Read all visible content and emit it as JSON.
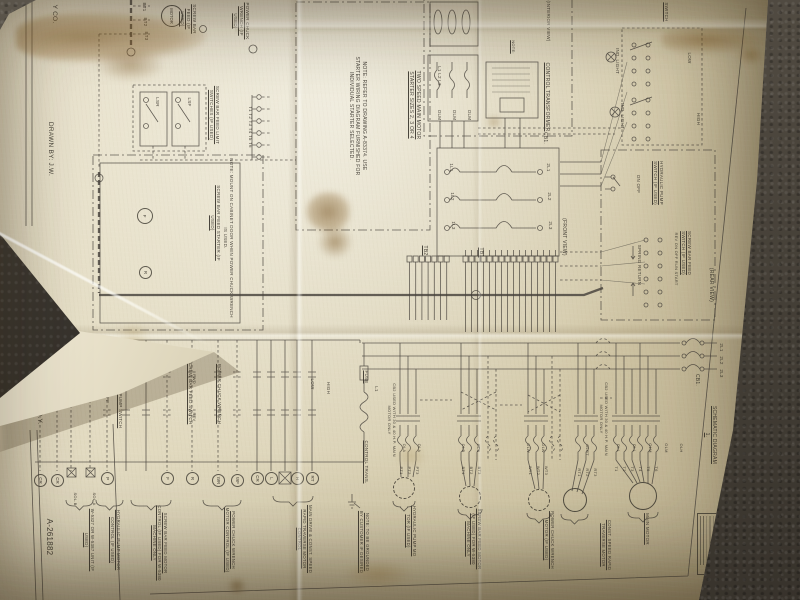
{
  "document": {
    "type": "photograph of an electrical wiring diagram drawing, rotated 90 degrees on dark carpet",
    "drawing_number": "A-261882"
  },
  "colors": {
    "paper": "#e0d8bd",
    "ink": "#45413a",
    "carpet": "#4b463e",
    "stain": "#7a541e"
  },
  "labels": [
    {
      "n": "company-name",
      "t": "Y CO.",
      "x": 58,
      "y": 2,
      "w": 24,
      "fs": 6.5,
      "ul": false
    },
    {
      "n": "drawn-by",
      "t": "DRAWN BY: J.W.",
      "x": 54,
      "y": 120,
      "w": 58,
      "fs": 6.5,
      "ul": false
    },
    {
      "n": "approved-by",
      "t": "APPR. BY: R.Y.",
      "x": 43,
      "y": 374,
      "w": 52,
      "fs": 6.5,
      "ul": false
    },
    {
      "n": "drawing-number",
      "t": "A-261882",
      "x": 54,
      "y": 514,
      "w": 46,
      "fs": 8,
      "ul": false
    },
    {
      "n": "terminal-bt1",
      "t": "BT1",
      "x": 147,
      "y": 1,
      "w": 12,
      "fs": 4.5,
      "ul": false
    },
    {
      "n": "terminal-bt2",
      "t": "BT2",
      "x": 148,
      "y": 16,
      "w": 12,
      "fs": 4.5,
      "ul": false
    },
    {
      "n": "terminal-bt3",
      "t": "BT3",
      "x": 149,
      "y": 30,
      "w": 12,
      "fs": 4.5,
      "ul": false
    },
    {
      "n": "screw-bar-feed-motor-top",
      "t": "SCREW BAR FEED (IF USED)",
      "x": 197,
      "y": 1,
      "w": 36,
      "fs": 4.5,
      "ul": true
    },
    {
      "n": "limit-switches",
      "t": "SCREW BAR FEED LIMIT SWITCHES (IF USED)",
      "x": 220,
      "y": 83,
      "w": 64,
      "fs": 4.5,
      "ul": true
    },
    {
      "n": "lsr",
      "t": "LSR",
      "x": 160,
      "y": 95,
      "w": 14,
      "fs": 4.5,
      "ul": false
    },
    {
      "n": "lsf",
      "t": "LSF",
      "x": 192,
      "y": 95,
      "w": 14,
      "fs": 4.5,
      "ul": false
    },
    {
      "n": "terminals-t1-t6",
      "t": "T1 T2 T3 T4 T5 T6",
      "x": 253,
      "y": 92,
      "w": 70,
      "fs": 4.5,
      "ul": false
    },
    {
      "n": "screw-bar-feed-starter",
      "t": "SCREW BAR FEED STARTER (IF USED)",
      "x": 221,
      "y": 178,
      "w": 90,
      "fs": 4.5,
      "ul": true
    },
    {
      "n": "starter-mount-note",
      "t": "NOTE: MOUNT ON CABINET DOOR WHEN POWER CHUCK WRENCH IS USED.",
      "x": 234,
      "y": 158,
      "w": 160,
      "fs": 4.5,
      "ul": false
    },
    {
      "n": "power-chuck-wrench-top",
      "t": "POWER CHUCK WRENCH (IF USED)",
      "x": 250,
      "y": 1,
      "w": 40,
      "fs": 4.5,
      "ul": true
    },
    {
      "n": "note-refer-drawing",
      "t": "NOTE: REFER TO DRAWING A-83374. USE STARTER WIRING DIAGRAM FURNISHED FOR INDIVIDUAL STARTER SELECTED.",
      "x": 367,
      "y": 56,
      "w": 120,
      "fs": 5,
      "ul": false
    },
    {
      "n": "two-speed-starter",
      "t": "TWO SPEED MAIN MOTOR STARTER SIZES 2, 3 OR 4",
      "x": 421,
      "y": 70,
      "w": 70,
      "fs": 5,
      "ul": true
    },
    {
      "n": "interior-view",
      "t": "(INTERIOR VIEW)",
      "x": 551,
      "y": 0,
      "w": 42,
      "fs": 4.5,
      "ul": false
    },
    {
      "n": "phase-l1l2l3",
      "t": "L1 L2 L3",
      "x": 442,
      "y": 58,
      "w": 36,
      "fs": 4.5,
      "ul": false
    },
    {
      "n": "olm-1",
      "t": "OLM",
      "x": 442,
      "y": 107,
      "w": 16,
      "fs": 4.5,
      "ul": false
    },
    {
      "n": "olm-2",
      "t": "OLM",
      "x": 457,
      "y": 107,
      "w": 16,
      "fs": 4.5,
      "ul": false
    },
    {
      "n": "olm-3",
      "t": "OLM",
      "x": 472,
      "y": 107,
      "w": 16,
      "fs": 4.5,
      "ul": false
    },
    {
      "n": "note-small",
      "t": "NOTE:",
      "x": 516,
      "y": 37,
      "w": 20,
      "fs": 4,
      "ul": true
    },
    {
      "n": "control-transformer",
      "t": "CONTROL TRANSFORMER",
      "x": 550,
      "y": 53,
      "w": 88,
      "fs": 5,
      "ul": true
    },
    {
      "n": "cb1-top",
      "t": "CB1.",
      "x": 548,
      "y": 130,
      "w": 16,
      "fs": 5,
      "ul": false
    },
    {
      "n": "switch-top",
      "t": "SWITCH",
      "x": 669,
      "y": 0,
      "w": 24,
      "fs": 4.5,
      "ul": true
    },
    {
      "n": "ind-light-1",
      "t": "IND. LIGHT",
      "x": 620,
      "y": 46,
      "w": 30,
      "fs": 4.5,
      "ul": false
    },
    {
      "n": "ind-light-2",
      "t": "IND. LIGHT",
      "x": 625,
      "y": 101,
      "w": 30,
      "fs": 4.5,
      "ul": false
    },
    {
      "n": "drum-low",
      "t": "LOW",
      "x": 692,
      "y": 50,
      "w": 16,
      "fs": 4.5,
      "ul": false
    },
    {
      "n": "drum-high",
      "t": "HIGH",
      "x": 701,
      "y": 110,
      "w": 18,
      "fs": 4.5,
      "ul": false
    },
    {
      "n": "hydraulic-pump-switch-r",
      "t": "HYDRAULIC PUMP SWITCH (IF USED)",
      "x": 664,
      "y": 160,
      "w": 46,
      "fs": 4.5,
      "ul": true
    },
    {
      "n": "hyd-on-off",
      "t": "ON OFF",
      "x": 641,
      "y": 172,
      "w": 24,
      "fs": 4.5,
      "ul": false
    },
    {
      "n": "screw-bar-feed-switch-r",
      "t": "SCREW BAR FEED SWITCH (IF USED)",
      "x": 692,
      "y": 226,
      "w": 54,
      "fs": 4.5,
      "ul": true
    },
    {
      "n": "sbf-positions",
      "t": "REV ON OFF RUN START",
      "x": 679,
      "y": 230,
      "w": 58,
      "fs": 4,
      "ul": false
    },
    {
      "n": "spring-return",
      "t": "SPRING RETURN",
      "x": 642,
      "y": 241,
      "w": 48,
      "fs": 4.5,
      "ul": false
    },
    {
      "n": "rear-view",
      "t": "(REAR VIEW)",
      "x": 714,
      "y": 263,
      "w": 44,
      "fs": 5,
      "ul": false
    },
    {
      "n": "breaker-1l1",
      "t": "1L1",
      "x": 454,
      "y": 161,
      "w": 13,
      "fs": 4.5,
      "ul": false
    },
    {
      "n": "breaker-1l2",
      "t": "1L2",
      "x": 455,
      "y": 190,
      "w": 13,
      "fs": 4.5,
      "ul": false
    },
    {
      "n": "breaker-1l3",
      "t": "1L3",
      "x": 456,
      "y": 219,
      "w": 13,
      "fs": 4.5,
      "ul": false
    },
    {
      "n": "breaker-2l1",
      "t": "2L1",
      "x": 551,
      "y": 161,
      "w": 13,
      "fs": 4.5,
      "ul": false
    },
    {
      "n": "breaker-2l2",
      "t": "2L2",
      "x": 552,
      "y": 190,
      "w": 13,
      "fs": 4.5,
      "ul": false
    },
    {
      "n": "breaker-2l3",
      "t": "2L3",
      "x": 553,
      "y": 219,
      "w": 13,
      "fs": 4.5,
      "ul": false
    },
    {
      "n": "front-view",
      "t": "(FRONT VIEW)",
      "x": 567,
      "y": 210,
      "w": 54,
      "fs": 5,
      "ul": false
    },
    {
      "n": "tb2",
      "t": "TB2",
      "x": 428,
      "y": 243,
      "w": 15,
      "fs": 5,
      "ul": true
    },
    {
      "n": "tb1",
      "t": "TB1",
      "x": 484,
      "y": 245,
      "w": 15,
      "fs": 5,
      "ul": true
    },
    {
      "n": "fuse",
      "t": "FUSE",
      "x": 369,
      "y": 368,
      "w": 18,
      "fs": 4.5,
      "ul": true
    },
    {
      "n": "line-l1",
      "t": "L1",
      "x": 379,
      "y": 384,
      "w": 10,
      "fs": 4.5,
      "ul": false
    },
    {
      "n": "control-trans-schematic",
      "t": "CONTROL TRANS.",
      "x": 369,
      "y": 436,
      "w": 52,
      "fs": 4.5,
      "ul": true
    },
    {
      "n": "cb2-note-left",
      "t": "CB2 USED WITH 30 & 40 H.P. MAIN MOTOR ONLY",
      "x": 397,
      "y": 376,
      "w": 88,
      "fs": 4,
      "ul": false
    },
    {
      "n": "cb2-note-right",
      "t": "CB2 USED WITH 30 & 40 H.P. MAIN MOTOR ONLY",
      "x": 609,
      "y": 374,
      "w": 90,
      "fs": 4,
      "ul": false
    },
    {
      "n": "cb1-right",
      "t": "CB1.",
      "x": 700,
      "y": 372,
      "w": 16,
      "fs": 5,
      "ul": false
    },
    {
      "n": "sch-2l1",
      "t": "2L1",
      "x": 724,
      "y": 341,
      "w": 13,
      "fs": 4.5,
      "ul": false
    },
    {
      "n": "sch-2l2",
      "t": "2L2",
      "x": 724,
      "y": 354,
      "w": 13,
      "fs": 4.5,
      "ul": false
    },
    {
      "n": "sch-2l3",
      "t": "2L3",
      "x": 724,
      "y": 367,
      "w": 13,
      "fs": 4.5,
      "ul": false
    },
    {
      "n": "schematic-diagram-title",
      "t": "SCHEMATIC DIAGRAM 1.",
      "x": 717,
      "y": 403,
      "w": 64,
      "fs": 5,
      "ul": true
    },
    {
      "n": "ol-a1",
      "t": "OLA",
      "x": 407,
      "y": 441,
      "w": 14,
      "fs": 4,
      "ul": false
    },
    {
      "n": "ol-a2",
      "t": "OLA",
      "x": 422,
      "y": 441,
      "w": 14,
      "fs": 4,
      "ul": false
    },
    {
      "n": "ol-b1",
      "t": "OLB",
      "x": 466,
      "y": 441,
      "w": 14,
      "fs": 4,
      "ul": false
    },
    {
      "n": "ol-b2",
      "t": "OLB",
      "x": 481,
      "y": 441,
      "w": 14,
      "fs": 4,
      "ul": false
    },
    {
      "n": "ol-w1",
      "t": "OLW",
      "x": 531,
      "y": 441,
      "w": 14,
      "fs": 4,
      "ul": false
    },
    {
      "n": "ol-w2",
      "t": "OLW",
      "x": 546,
      "y": 441,
      "w": 14,
      "fs": 4,
      "ul": false
    },
    {
      "n": "ol-rt",
      "t": "OLRT",
      "x": 590,
      "y": 441,
      "w": 18,
      "fs": 4,
      "ul": false
    },
    {
      "n": "ol-l1",
      "t": "OLL",
      "x": 621,
      "y": 441,
      "w": 14,
      "fs": 4,
      "ul": false
    },
    {
      "n": "ol-l2",
      "t": "OLL",
      "x": 637,
      "y": 441,
      "w": 14,
      "fs": 4,
      "ul": false
    },
    {
      "n": "ol-m1",
      "t": "OLM",
      "x": 653,
      "y": 441,
      "w": 14,
      "fs": 4,
      "ul": false
    },
    {
      "n": "ol-m2",
      "t": "OLM",
      "x": 669,
      "y": 441,
      "w": 14,
      "fs": 4,
      "ul": false
    },
    {
      "n": "ol-h",
      "t": "OLH",
      "x": 684,
      "y": 441,
      "w": 14,
      "fs": 4,
      "ul": false
    },
    {
      "n": "term-pt1",
      "t": "PT1",
      "x": 404,
      "y": 464,
      "w": 13,
      "fs": 4,
      "ul": false
    },
    {
      "n": "term-pt2",
      "t": "PT2",
      "x": 412,
      "y": 464,
      "w": 13,
      "fs": 4,
      "ul": false
    },
    {
      "n": "term-pt3",
      "t": "PT3",
      "x": 420,
      "y": 464,
      "w": 13,
      "fs": 4,
      "ul": false
    },
    {
      "n": "term-bt1",
      "t": "BT1",
      "x": 466,
      "y": 464,
      "w": 13,
      "fs": 4,
      "ul": false
    },
    {
      "n": "term-bt2",
      "t": "BT2",
      "x": 474,
      "y": 464,
      "w": 13,
      "fs": 4,
      "ul": false
    },
    {
      "n": "term-bt3",
      "t": "BT3",
      "x": 482,
      "y": 464,
      "w": 13,
      "fs": 4,
      "ul": false
    },
    {
      "n": "term-wt1",
      "t": "WT1",
      "x": 533,
      "y": 464,
      "w": 13,
      "fs": 4,
      "ul": false
    },
    {
      "n": "term-wt2",
      "t": "WT2",
      "x": 541,
      "y": 464,
      "w": 13,
      "fs": 4,
      "ul": false
    },
    {
      "n": "term-wt3",
      "t": "WT3",
      "x": 549,
      "y": 464,
      "w": 13,
      "fs": 4,
      "ul": false
    },
    {
      "n": "term-rt1",
      "t": "RT1",
      "x": 582,
      "y": 466,
      "w": 13,
      "fs": 4,
      "ul": false
    },
    {
      "n": "term-rt2",
      "t": "RT2",
      "x": 590,
      "y": 466,
      "w": 13,
      "fs": 4,
      "ul": false
    },
    {
      "n": "term-rt3",
      "t": "RT3",
      "x": 598,
      "y": 466,
      "w": 13,
      "fs": 4,
      "ul": false
    },
    {
      "n": "term-t1",
      "t": "T1",
      "x": 619,
      "y": 464,
      "w": 10,
      "fs": 4,
      "ul": false
    },
    {
      "n": "term-t2",
      "t": "T2",
      "x": 627,
      "y": 464,
      "w": 10,
      "fs": 4,
      "ul": false
    },
    {
      "n": "term-t3",
      "t": "T3",
      "x": 635,
      "y": 464,
      "w": 10,
      "fs": 4,
      "ul": false
    },
    {
      "n": "term-t4",
      "t": "T4",
      "x": 643,
      "y": 464,
      "w": 10,
      "fs": 4,
      "ul": false
    },
    {
      "n": "term-t5",
      "t": "T5",
      "x": 651,
      "y": 464,
      "w": 10,
      "fs": 4,
      "ul": false
    },
    {
      "n": "term-t6",
      "t": "T6",
      "x": 659,
      "y": 464,
      "w": 10,
      "fs": 4,
      "ul": false
    },
    {
      "n": "ladder-on-off",
      "t": "ON OFF",
      "x": 110,
      "y": 382,
      "w": 24,
      "fs": 4.5,
      "ul": false
    },
    {
      "n": "hydraulic-pump-switch-l",
      "t": "HYDRAULIC PUMP SWITCH",
      "x": 123,
      "y": 358,
      "w": 76,
      "fs": 4.5,
      "ul": true
    },
    {
      "n": "screw-bar-feed-switch-l",
      "t": "SCREW BAR FEED SWITCH",
      "x": 193,
      "y": 352,
      "w": 80,
      "fs": 4.5,
      "ul": true
    },
    {
      "n": "ladder-fwd",
      "t": "FWD",
      "x": 197,
      "y": 372,
      "w": 14,
      "fs": 4,
      "ul": false
    },
    {
      "n": "ladder-rev",
      "t": "REV",
      "x": 197,
      "y": 410,
      "w": 14,
      "fs": 4,
      "ul": false
    },
    {
      "n": "power-chuck-wrench-l",
      "t": "POWER CHUCK WRENCH",
      "x": 222,
      "y": 360,
      "w": 68,
      "fs": 4.5,
      "ul": true
    },
    {
      "n": "ladder-low",
      "t": "LOW",
      "x": 315,
      "y": 376,
      "w": 16,
      "fs": 4.5,
      "ul": false
    },
    {
      "n": "ladder-high",
      "t": "HIGH",
      "x": 331,
      "y": 379,
      "w": 18,
      "fs": 4.5,
      "ul": false
    },
    {
      "n": "sol-b",
      "t": "SOL.B",
      "x": 78,
      "y": 489,
      "w": 20,
      "fs": 4,
      "ul": false
    },
    {
      "n": "sol-a",
      "t": "SOL.A",
      "x": 97,
      "y": 489,
      "w": 20,
      "fs": 4,
      "ul": false
    },
    {
      "n": "bracket-w5327-unit",
      "t": "W-5327 OR W-5387 UNIT (IF USED)",
      "x": 95,
      "y": 503,
      "w": 74,
      "fs": 4.3,
      "ul": true
    },
    {
      "n": "bracket-hyd-pump-control",
      "t": "HYDRAULIC PUMP MOTOR CONTROL (IF USED)",
      "x": 121,
      "y": 503,
      "w": 74,
      "fs": 4.3,
      "ul": true
    },
    {
      "n": "bracket-sbf-control",
      "t": "SCREW BAR FEED MOTOR CONTROL (IF USED) FOR W-5380 MACHINE ONLY",
      "x": 168,
      "y": 503,
      "w": 80,
      "fs": 4.3,
      "ul": true
    },
    {
      "n": "bracket-pcw-control",
      "t": "POWER CHUCK WRENCH MOTOR CONTROL (IF USED)",
      "x": 236,
      "y": 503,
      "w": 74,
      "fs": 4.3,
      "ul": true
    },
    {
      "n": "bracket-main-drive-control",
      "t": "MAIN DRIVE & CONST. SPEED RAPID TRAVERSE MOTOR CONTROL",
      "x": 313,
      "y": 498,
      "w": 82,
      "fs": 4.3,
      "ul": true
    },
    {
      "n": "hydraulic-pump-motor",
      "t": "HYDRAULIC PUMP MO TOR (IF USED)",
      "x": 417,
      "y": 502,
      "w": 58,
      "fs": 4.3,
      "ul": true
    },
    {
      "n": "screw-bar-feed-motor",
      "t": "SCREW BAR FEED MOTOR (IF USED) FOR W-5380 MACHINE ONLY",
      "x": 482,
      "y": 506,
      "w": 66,
      "fs": 4.3,
      "ul": true
    },
    {
      "n": "power-chuck-wrench-motor",
      "t": "POWER CHUCK WRENCH MOTOR (IF USED)",
      "x": 555,
      "y": 510,
      "w": 60,
      "fs": 4.3,
      "ul": true
    },
    {
      "n": "rapid-traverse-motor",
      "t": "CONST. SPEED RAPID TRAVERSE MOTOR",
      "x": 612,
      "y": 514,
      "w": 62,
      "fs": 4.3,
      "ul": true
    },
    {
      "n": "main-motor",
      "t": "MAIN MOTOR",
      "x": 650,
      "y": 513,
      "w": 32,
      "fs": 4.5,
      "ul": true
    },
    {
      "n": "ground-note",
      "t": "NOTE: TO BE GROUNDED BY CUSTOMER IF DESIRED",
      "x": 370,
      "y": 510,
      "w": 64,
      "fs": 4.3,
      "ul": true
    }
  ],
  "coils": [
    {
      "t": "CR",
      "x": 40,
      "y": 480
    },
    {
      "t": "CR",
      "x": 57,
      "y": 480
    },
    {
      "t": "P",
      "x": 107,
      "y": 478
    },
    {
      "t": "F",
      "x": 167,
      "y": 478
    },
    {
      "t": "R",
      "x": 192,
      "y": 478
    },
    {
      "t": "WR",
      "x": 218,
      "y": 480
    },
    {
      "t": "WF",
      "x": 237,
      "y": 480
    },
    {
      "t": "CR",
      "x": 257,
      "y": 478
    },
    {
      "t": "L",
      "x": 271,
      "y": 478
    },
    {
      "t": "H",
      "x": 297,
      "y": 478
    },
    {
      "t": "RT",
      "x": 312,
      "y": 478
    },
    {
      "t": "F",
      "x": 145,
      "y": 216
    },
    {
      "t": "R",
      "x": 145,
      "y": 272
    }
  ],
  "motors": [
    {
      "t": "MOTOR",
      "x": 172,
      "y": 16,
      "r": 11,
      "dash": false
    },
    {
      "t": "",
      "x": 404,
      "y": 488,
      "r": 11,
      "dash": true
    },
    {
      "t": "",
      "x": 470,
      "y": 497,
      "r": 11,
      "dash": true
    },
    {
      "t": "",
      "x": 539,
      "y": 500,
      "r": 11,
      "dash": true
    },
    {
      "t": "",
      "x": 575,
      "y": 500,
      "r": 12,
      "dash": false
    },
    {
      "t": "",
      "x": 643,
      "y": 496,
      "r": 14,
      "dash": false
    }
  ]
}
